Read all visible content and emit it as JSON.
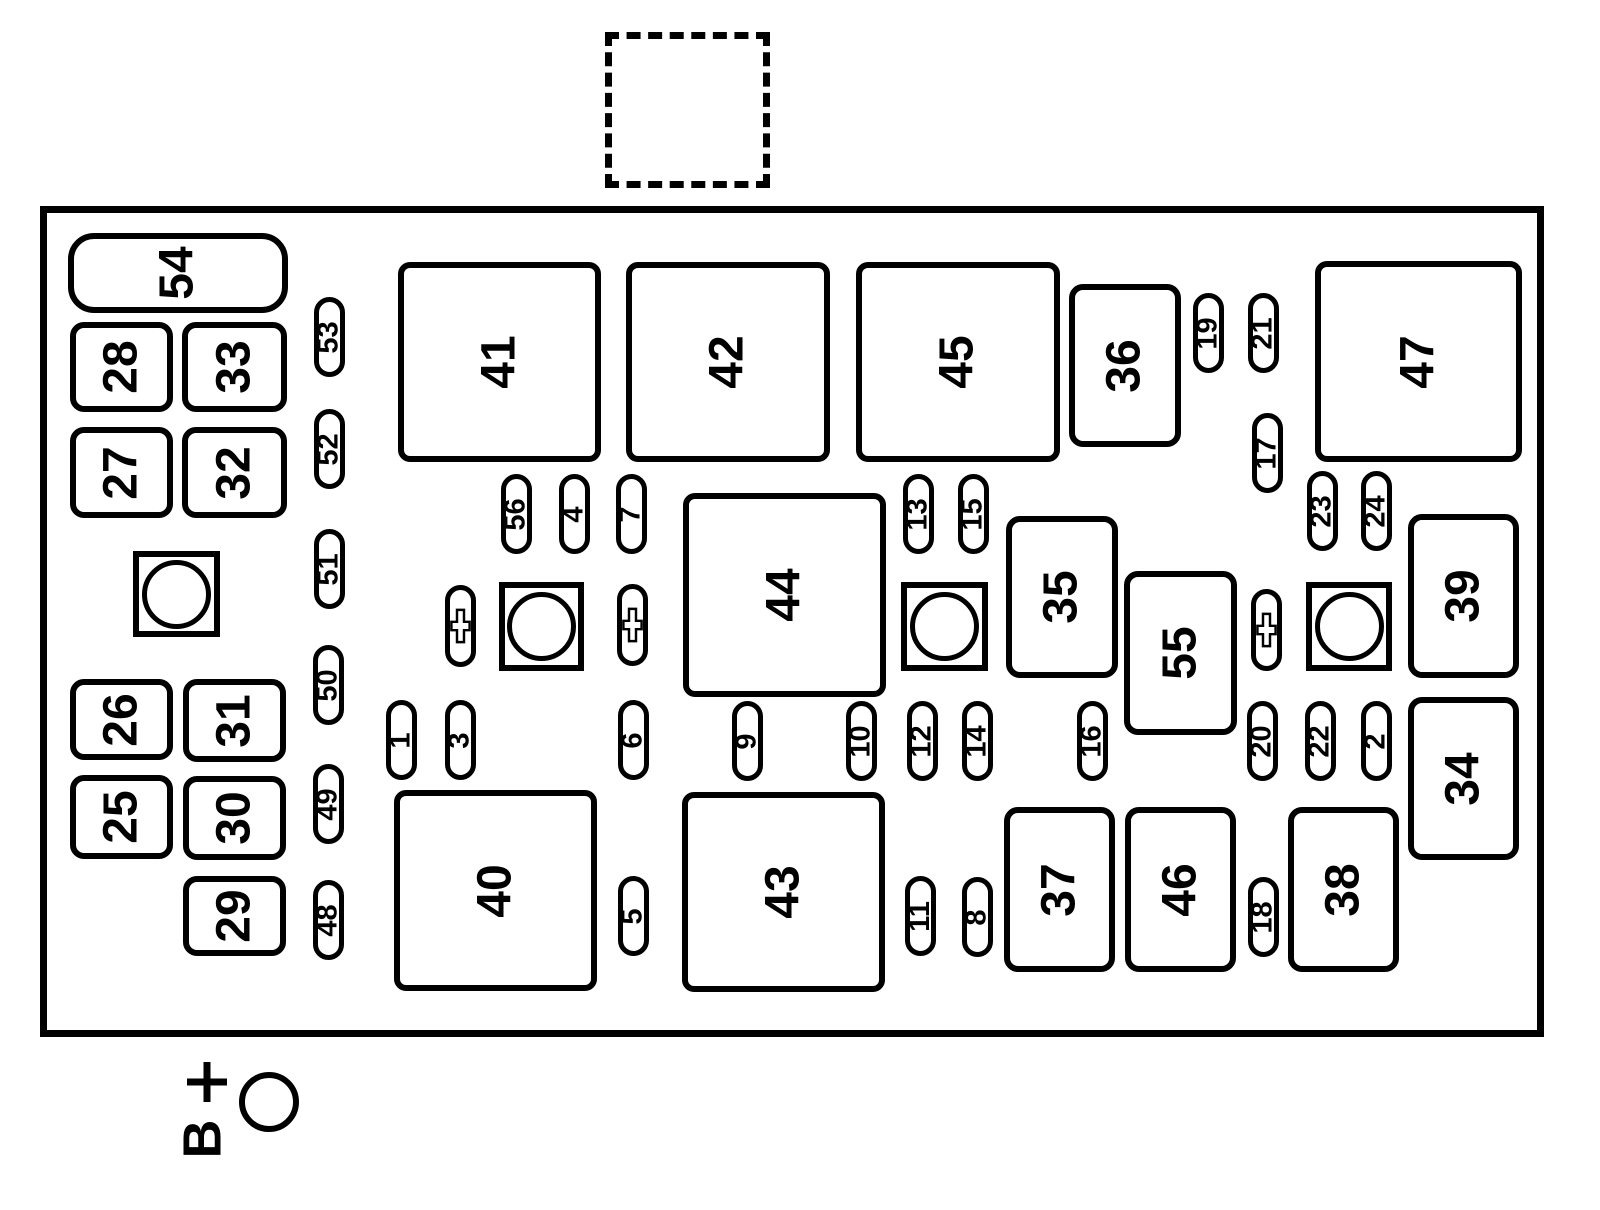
{
  "diagram": {
    "kind": "fuse-block-diagram",
    "line_color": "#000000",
    "background_color": "#ffffff",
    "panel": {
      "x": 40,
      "y": 206,
      "w": 1504,
      "h": 831
    },
    "dashed_connector_box": {
      "x": 605,
      "y": 32,
      "w": 165,
      "h": 156
    }
  },
  "boxes": [
    {
      "label": "54",
      "x": 68,
      "y": 233,
      "w": 220,
      "h": 80,
      "r": 26
    },
    {
      "label": "28",
      "x": 70,
      "y": 322,
      "w": 103,
      "h": 90,
      "r": 14
    },
    {
      "label": "33",
      "x": 182,
      "y": 322,
      "w": 105,
      "h": 90,
      "r": 14
    },
    {
      "label": "27",
      "x": 70,
      "y": 427,
      "w": 103,
      "h": 91,
      "r": 14
    },
    {
      "label": "32",
      "x": 182,
      "y": 427,
      "w": 105,
      "h": 91,
      "r": 14
    },
    {
      "label": "26",
      "x": 70,
      "y": 679,
      "w": 103,
      "h": 81,
      "r": 14
    },
    {
      "label": "31",
      "x": 183,
      "y": 679,
      "w": 103,
      "h": 83,
      "r": 14
    },
    {
      "label": "25",
      "x": 70,
      "y": 775,
      "w": 103,
      "h": 84,
      "r": 14
    },
    {
      "label": "30",
      "x": 183,
      "y": 776,
      "w": 103,
      "h": 84,
      "r": 14
    },
    {
      "label": "29",
      "x": 183,
      "y": 876,
      "w": 103,
      "h": 80,
      "r": 14
    },
    {
      "label": "41",
      "x": 398,
      "y": 262,
      "w": 203,
      "h": 200,
      "r": 12
    },
    {
      "label": "42",
      "x": 626,
      "y": 262,
      "w": 204,
      "h": 200,
      "r": 12
    },
    {
      "label": "45",
      "x": 856,
      "y": 262,
      "w": 204,
      "h": 200,
      "r": 12
    },
    {
      "label": "36",
      "x": 1069,
      "y": 284,
      "w": 112,
      "h": 163,
      "r": 14
    },
    {
      "label": "47",
      "x": 1315,
      "y": 261,
      "w": 207,
      "h": 201,
      "r": 12
    },
    {
      "label": "44",
      "x": 683,
      "y": 493,
      "w": 203,
      "h": 204,
      "r": 12
    },
    {
      "label": "35",
      "x": 1006,
      "y": 516,
      "w": 112,
      "h": 162,
      "r": 14
    },
    {
      "label": "55",
      "x": 1124,
      "y": 571,
      "w": 113,
      "h": 164,
      "r": 14
    },
    {
      "label": "39",
      "x": 1408,
      "y": 514,
      "w": 111,
      "h": 164,
      "r": 14
    },
    {
      "label": "34",
      "x": 1408,
      "y": 697,
      "w": 111,
      "h": 163,
      "r": 14
    },
    {
      "label": "40",
      "x": 394,
      "y": 790,
      "w": 203,
      "h": 201,
      "r": 12
    },
    {
      "label": "43",
      "x": 682,
      "y": 792,
      "w": 203,
      "h": 200,
      "r": 12
    },
    {
      "label": "37",
      "x": 1004,
      "y": 807,
      "w": 111,
      "h": 165,
      "r": 14
    },
    {
      "label": "46",
      "x": 1125,
      "y": 807,
      "w": 111,
      "h": 165,
      "r": 14
    },
    {
      "label": "38",
      "x": 1288,
      "y": 807,
      "w": 111,
      "h": 165,
      "r": 14
    }
  ],
  "fuses": [
    {
      "label": "53",
      "x": 314,
      "y": 297
    },
    {
      "label": "52",
      "x": 314,
      "y": 409
    },
    {
      "label": "51",
      "x": 314,
      "y": 529
    },
    {
      "label": "50",
      "x": 313,
      "y": 645
    },
    {
      "label": "49",
      "x": 313,
      "y": 764
    },
    {
      "label": "48",
      "x": 313,
      "y": 880
    },
    {
      "label": "56",
      "x": 501,
      "y": 474
    },
    {
      "label": "4",
      "x": 559,
      "y": 474
    },
    {
      "label": "7",
      "x": 616,
      "y": 474
    },
    {
      "label": "13",
      "x": 903,
      "y": 474
    },
    {
      "label": "15",
      "x": 958,
      "y": 474
    },
    {
      "label": "19",
      "x": 1193,
      "y": 293
    },
    {
      "label": "21",
      "x": 1248,
      "y": 293
    },
    {
      "label": "17",
      "x": 1252,
      "y": 413
    },
    {
      "label": "23",
      "x": 1307,
      "y": 471
    },
    {
      "label": "24",
      "x": 1361,
      "y": 471
    },
    {
      "label": "1",
      "x": 386,
      "y": 700
    },
    {
      "label": "3",
      "x": 445,
      "y": 700
    },
    {
      "label": "6",
      "x": 618,
      "y": 700
    },
    {
      "label": "9",
      "x": 732,
      "y": 701
    },
    {
      "label": "10",
      "x": 846,
      "y": 701
    },
    {
      "label": "12",
      "x": 907,
      "y": 701
    },
    {
      "label": "14",
      "x": 962,
      "y": 701
    },
    {
      "label": "16",
      "x": 1077,
      "y": 701
    },
    {
      "label": "20",
      "x": 1247,
      "y": 701
    },
    {
      "label": "22",
      "x": 1305,
      "y": 701
    },
    {
      "label": "2",
      "x": 1361,
      "y": 701
    },
    {
      "label": "5",
      "x": 618,
      "y": 876
    },
    {
      "label": "11",
      "x": 905,
      "y": 876
    },
    {
      "label": "8",
      "x": 962,
      "y": 877
    },
    {
      "label": "18",
      "x": 1248,
      "y": 877
    }
  ],
  "fuse_size": {
    "w": 31,
    "h": 80
  },
  "mount_holes": [
    {
      "x": 133,
      "y": 551,
      "w": 87,
      "h": 86
    },
    {
      "x": 499,
      "y": 582,
      "w": 85,
      "h": 89
    },
    {
      "x": 901,
      "y": 582,
      "w": 87,
      "h": 89
    },
    {
      "x": 1306,
      "y": 582,
      "w": 86,
      "h": 89
    }
  ],
  "bolt_slots": [
    {
      "x": 445,
      "y": 585,
      "w": 31,
      "h": 82
    },
    {
      "x": 617,
      "y": 584,
      "w": 31,
      "h": 82
    },
    {
      "x": 1251,
      "y": 589,
      "w": 31,
      "h": 82
    }
  ],
  "battery": {
    "letter": "B",
    "plus_sign": "+"
  }
}
